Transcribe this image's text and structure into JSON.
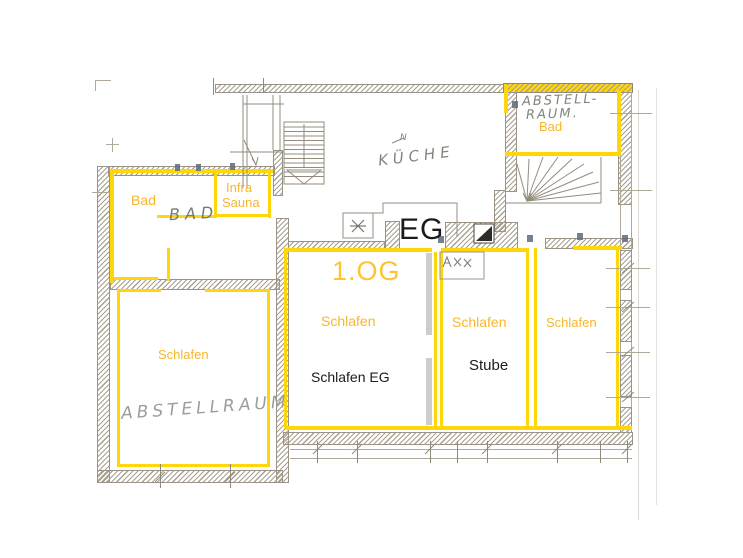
{
  "floor_plan": {
    "floor_labels": {
      "eg": "EG",
      "og": "1.OG"
    },
    "printed_labels": {
      "bad_upper_left": "Bad",
      "infra_line1": "Infra",
      "infra_line2": "Sauna",
      "bad_upper_right": "Bad",
      "schlafen_lower_left": "Schlafen",
      "schlafen_center": "Schlafen",
      "schlafen_eg": "Schlafen EG",
      "schlafen_middle": "Schlafen",
      "stube": "Stube",
      "schlafen_right": "Schlafen"
    },
    "handwritten_labels": {
      "bad": "BAD",
      "kueche": "KÜCHE",
      "kueche_note": "N",
      "abstellraum_og_line1": "ABSTELL-",
      "abstellraum_og_line2": "RAUM.",
      "abstellraum_eg": "ABSTELLRAUM"
    },
    "colors": {
      "marker_yellow": "#FFD60A",
      "label_amber": "#F8B62D",
      "og_label_color": "#FFC333",
      "pencil_gray": "#938C7E",
      "handwriting_gray": "#80857B",
      "ink_black": "#1B1B1B"
    }
  }
}
